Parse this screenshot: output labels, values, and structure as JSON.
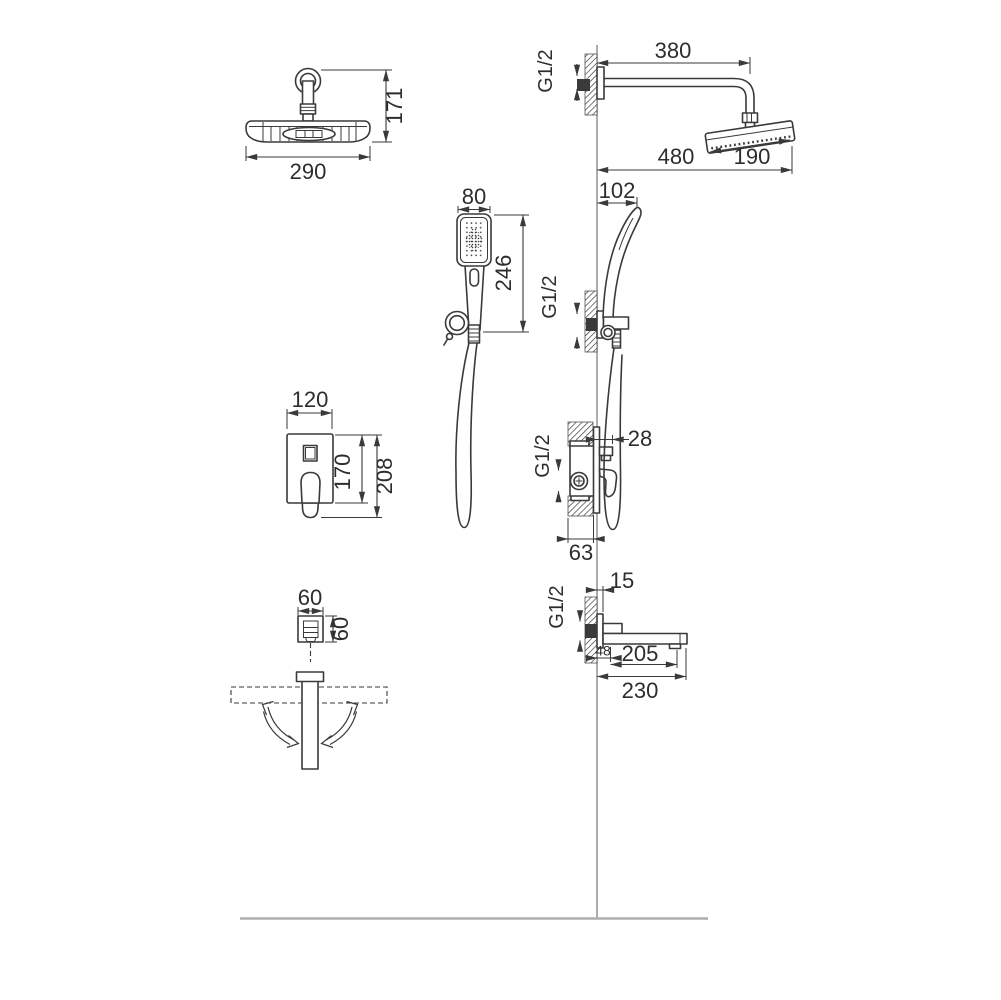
{
  "colors": {
    "line": "#3a3a3a",
    "text": "#2d2d2d",
    "wall_line": "#8a8a8a",
    "floor_line": "#adadad",
    "background": "#ffffff"
  },
  "views": {
    "overhead_shower_front": {
      "width": "290",
      "height": "171"
    },
    "shower_arm_side": {
      "arm_length": "380",
      "thread": "G1/2",
      "reach": "480",
      "head_width": "190",
      "head_clearance": "102"
    },
    "hand_shower_front": {
      "head_width": "80",
      "length": "246"
    },
    "hand_shower_holder_side": {
      "thread": "G1/2"
    },
    "mixer_front": {
      "plate_width": "120",
      "plate_height": "170",
      "overall_height": "208"
    },
    "mixer_side": {
      "handle_offset": "28",
      "thread": "G1/2",
      "recess_depth": "63"
    },
    "spout_front": {
      "width": "60",
      "height": "60"
    },
    "spout_side": {
      "plate_depth": "15",
      "thread": "G1/2",
      "base_length": "48",
      "reach": "205",
      "overall_reach": "230"
    }
  }
}
